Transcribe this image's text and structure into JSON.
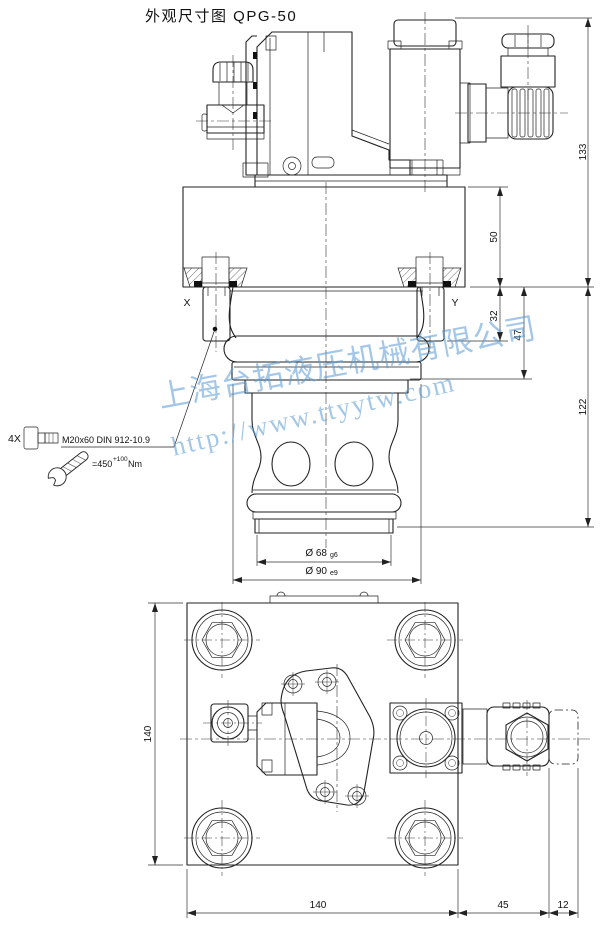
{
  "title": "外观尺寸图 QPG-50",
  "watermark": {
    "company": "上海台拓液压机械有限公司",
    "url": "http://www.ttyytw.com",
    "color": "#5b9bd5"
  },
  "bolt_note": {
    "qty": "4X",
    "spec": "M20x60 DIN 912-10.9",
    "torque": "=450",
    "torque_sup": "+100",
    "torque_unit": "Nm"
  },
  "side_view": {
    "label_x": "X",
    "label_y": "Y",
    "dim_total_height": "133",
    "dim_block_height": "50",
    "dim_sleeve": "32",
    "dim_step": "47",
    "dim_insert": "122",
    "dia_pilot": "Ø 68",
    "dia_pilot_fit": "g6",
    "dia_main": "Ø 90",
    "dia_main_fit": "e9"
  },
  "bottom_view": {
    "dim_width": "140",
    "dim_height": "140",
    "dim_plug": "45",
    "dim_plug_tip": "12"
  }
}
